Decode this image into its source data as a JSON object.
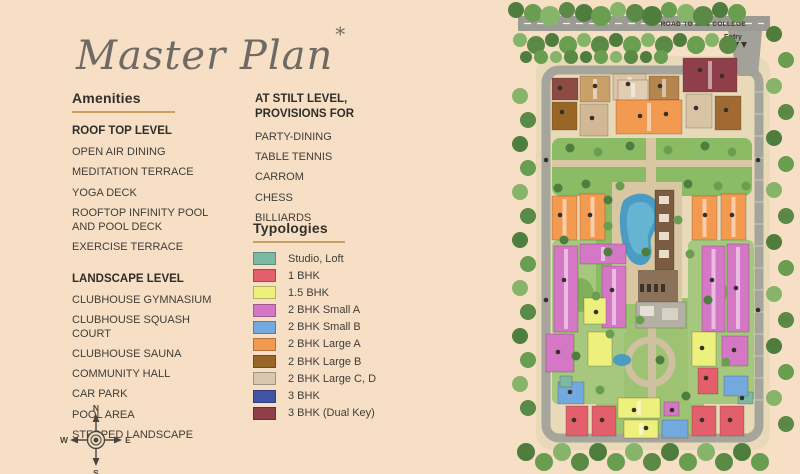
{
  "page": {
    "title": "Master Plan",
    "asterisk": "*",
    "background": "#f6dfc4",
    "accent_rule": "#c8a066"
  },
  "amenities": {
    "heading": "Amenities",
    "sections": [
      {
        "title": "ROOF TOP LEVEL",
        "items": [
          "OPEN AIR DINING",
          "MEDITATION TERRACE",
          "YOGA DECK",
          "ROOFTOP INFINITY POOL AND POOL DECK",
          "EXERCISE TERRACE"
        ]
      },
      {
        "title": "LANDSCAPE LEVEL",
        "items": [
          "CLUBHOUSE GYMNASIUM",
          "CLUBHOUSE SQUASH COURT",
          "CLUBHOUSE SAUNA",
          "COMMUNITY HALL",
          "CAR PARK",
          "POOL AREA",
          "STEPPED LANDSCAPE"
        ]
      }
    ]
  },
  "stilt_level": {
    "title": "AT STILT LEVEL, PROVISIONS FOR",
    "items": [
      "PARTY-DINING",
      "TABLE TENNIS",
      "CARROM",
      "CHESS",
      "BILLIARDS"
    ]
  },
  "typologies": {
    "heading": "Typologies",
    "items": [
      {
        "label": "Studio, Loft",
        "color": "#7cb9a4"
      },
      {
        "label": "1 BHK",
        "color": "#e35f6b"
      },
      {
        "label": "1.5 BHK",
        "color": "#eef07e"
      },
      {
        "label": "2 BHK Small A",
        "color": "#d478c5"
      },
      {
        "label": "2 BHK Small B",
        "color": "#74a9df"
      },
      {
        "label": "2 BHK Large A",
        "color": "#f29a50"
      },
      {
        "label": "2 BHK Large B",
        "color": "#9a6627"
      },
      {
        "label": "2 BHK Large C, D",
        "color": "#d9c6ae"
      },
      {
        "label": "3 BHK",
        "color": "#4053a5"
      },
      {
        "label": "3 BHK (Dual Key)",
        "color": "#8e3f49"
      }
    ]
  },
  "compass": {
    "n": "N",
    "e": "E",
    "s": "S",
    "w": "W"
  },
  "map": {
    "road_label": "ROAD TO MES COLLEGE",
    "entry_label": "Entry"
  }
}
